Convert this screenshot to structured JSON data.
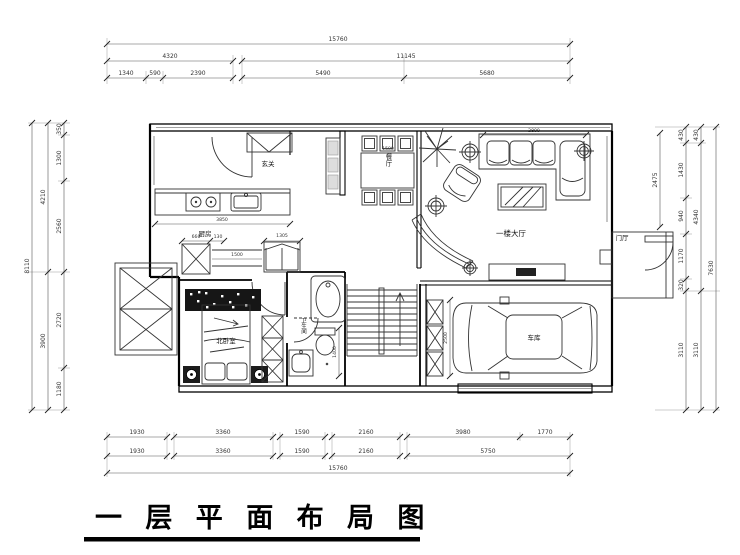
{
  "title": "一 层 平 面 布 局 图",
  "rooms": {
    "entry": "玄关",
    "kitchen": "厨房",
    "dining": "餐厅",
    "hall": "一楼大厅",
    "foyer": "门厅",
    "bedroom": "北卧室",
    "bathroom": "卫生间",
    "garage": "车库"
  },
  "dims": {
    "top": {
      "total": "15760",
      "mid": [
        "4320",
        "11145"
      ],
      "inner": [
        "1340",
        "590",
        "2390",
        "5490",
        "5680"
      ]
    },
    "bottom": {
      "upper": [
        "1930",
        "3360",
        "1590",
        "2160",
        "3980",
        "1770"
      ],
      "lower": [
        "1930",
        "3360",
        "1590",
        "2160",
        "5750"
      ],
      "total": "15760"
    },
    "left": {
      "total": "8110",
      "mid": [
        "4210",
        "3900"
      ],
      "inner": [
        "350",
        "1300",
        "2560",
        "2720",
        "1180"
      ]
    },
    "right": {
      "inner": [
        "430",
        "1430",
        "940",
        "1170",
        "320",
        "3110"
      ],
      "mid": [
        "430",
        "4340",
        "3110"
      ],
      "total": "7630",
      "porch": "2475"
    },
    "interior": {
      "kitchen_counter": "3850",
      "dining_table": "1500",
      "corridor_left": "660",
      "corridor_gap": "130",
      "corridor_shelf": "1500",
      "corridor_cabinet": "1305",
      "sofa": "2800",
      "bathroom": "1400",
      "garage_cabinet": "2500"
    }
  }
}
